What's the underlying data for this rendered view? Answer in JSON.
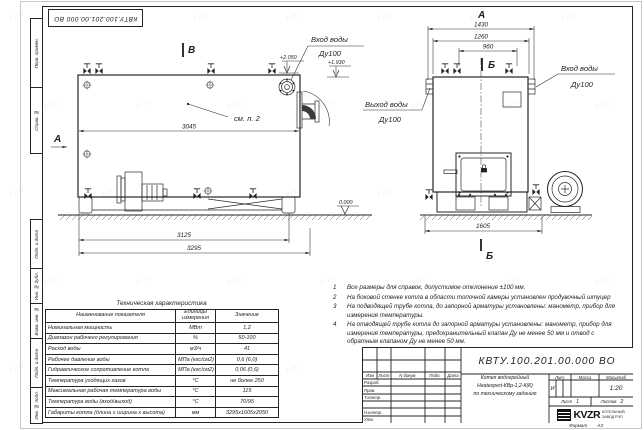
{
  "stamp_top": "КВТУ.100.201.00.000 ВО",
  "watermark": "kvzr",
  "margin_labels": [
    "Перв. примен.",
    "Справ. №",
    "Подп. и дата",
    "Инв. № дубл.",
    "Взам. инв. №",
    "Подп. и дата",
    "Инв. № подл."
  ],
  "drawing": {
    "side_view": {
      "view_marker_top": "В",
      "view_marker_left": "А",
      "callout": "см. п. 2",
      "dim_length_body": "3045",
      "dim_length_frame": "3125",
      "dim_length_overall": "3295",
      "elev_top": "+2.050",
      "elev_ground": "0.000",
      "label_inlet": "Вход воды",
      "label_inlet_dn": "Ду100"
    },
    "front_view": {
      "view_marker_top": "А",
      "section_marker_top": "Б",
      "section_marker_bottom": "Б",
      "dim_width_overall": "1430",
      "dim_width_body": "1260",
      "dim_width_valves": "960",
      "dim_width_base": "1605",
      "elev_inlet": "+1.930",
      "label_outlet": "Выход воды",
      "label_outlet_dn": "Ду100",
      "label_inlet": "Вход воды",
      "label_inlet_dn": "Ду100"
    }
  },
  "notes": {
    "items": [
      {
        "num": "1",
        "text": "Все размеры для справок, допустимое отклонение ±100 мм."
      },
      {
        "num": "2",
        "text": "На боковой стенке котла в области топочной камеры установлен продувочный штуцер"
      },
      {
        "num": "3",
        "text": "На подводящей трубе котла, до запорной арматуры установлены: манометр, прибор для измерения температуры."
      },
      {
        "num": "4",
        "text": "На отводящей трубе котла до запорной арматуры установлены: манометр, прибор для измерения температуры, предохранительный клапан Ду не менее 50 мм и отвод с обратным клапаном Ду не менее 50 мм."
      }
    ]
  },
  "tech_table": {
    "title": "Техническая характеристика",
    "headers": [
      "Наименование показателя",
      "Единицы измерения",
      "Значение"
    ],
    "rows": [
      [
        "Номинальная мощность",
        "МВт",
        "1,2"
      ],
      [
        "Диапазон рабочего регулирования",
        "%",
        "50-100"
      ],
      [
        "Расход воды",
        "м3/ч",
        "41"
      ],
      [
        "Рабочее давление воды",
        "МПа (кгс/см2)",
        "0,6 (6,0)"
      ],
      [
        "Гидравлическое сопротивление котла",
        "МПа (кгс/см2)",
        "0,06 (0,6)"
      ],
      [
        "Температура уходящих газов",
        "°С",
        "не более 250"
      ],
      [
        "Максимальная рабочая температура воды",
        "°С",
        "115"
      ],
      [
        "Температура воды (вход/выход)",
        "°С",
        "70/95"
      ],
      [
        "Габариты котла (длина х ширина х высота)",
        "мм",
        "3295х1605х2050"
      ]
    ]
  },
  "title_block": {
    "doc_number": "КВТУ.100.201.00.000 ВО",
    "sig_headers": [
      "Изм",
      "Лист",
      "N докум.",
      "Подп.",
      "Дата"
    ],
    "sig_rows": [
      "Разраб.",
      "Пров.",
      "Т.контр.",
      "",
      "Н.контр.",
      "Утв."
    ],
    "name_line1": "Котел водогрейный",
    "name_line2": "Heatexpert-КВр-1,2-К(К)",
    "name_line3": "по техническому заданию",
    "lit_header": "Лит.",
    "mass_header": "Масса",
    "scale_header": "Масштаб",
    "lit_value": "И",
    "scale_value": "1:20",
    "sheet_label": "Лист",
    "sheet_value": "1",
    "sheets_label": "Листов",
    "sheets_value": "2",
    "logo_text": "KVZR",
    "company_line1": "КОТЕЛЬНЫЙ",
    "company_line2": "ЗАВОД РЭП",
    "format_label": "Формат",
    "format_value": "А3"
  }
}
